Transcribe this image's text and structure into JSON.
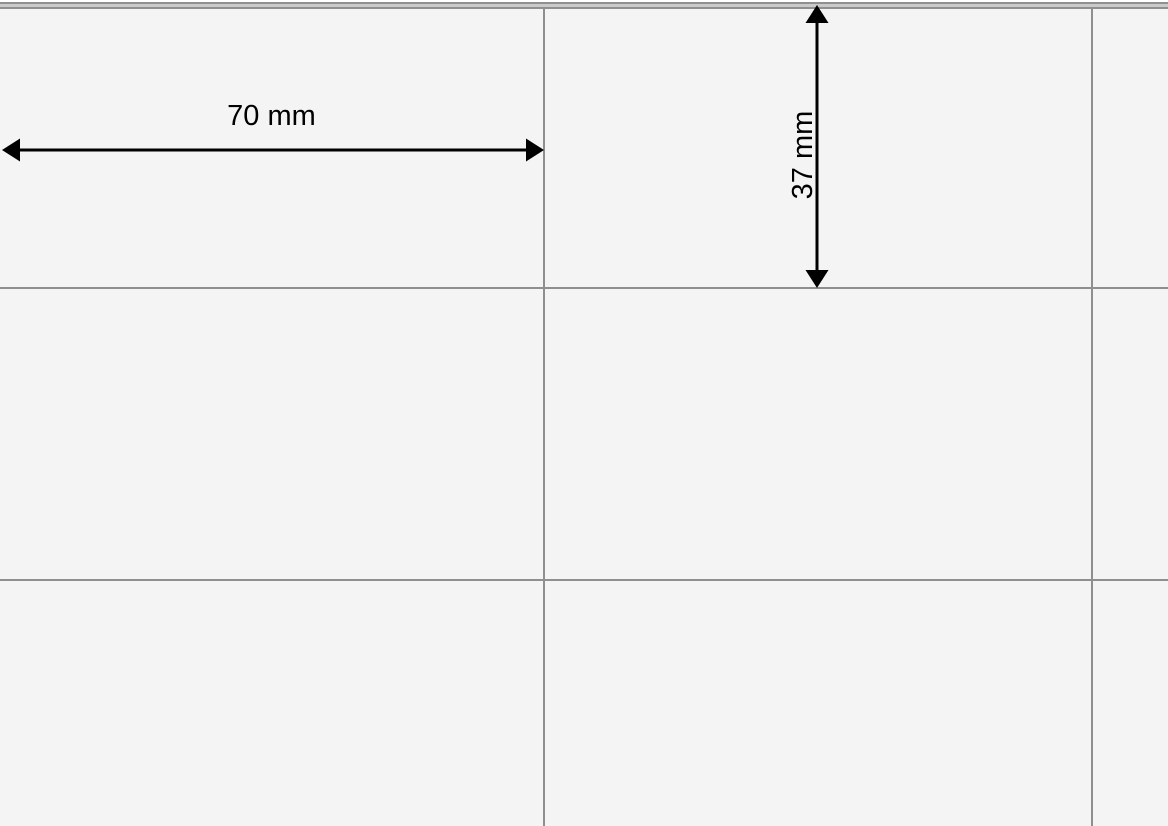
{
  "annotations": {
    "width_label": "70 mm",
    "height_label": "37 mm"
  },
  "colors": {
    "sheet_background": "#f4f4f4",
    "grid_line": "#8f8f8f",
    "page_top_strip": "#ffffff",
    "page_edge_gap": "#cacaca",
    "dimension_ink": "#000000"
  }
}
